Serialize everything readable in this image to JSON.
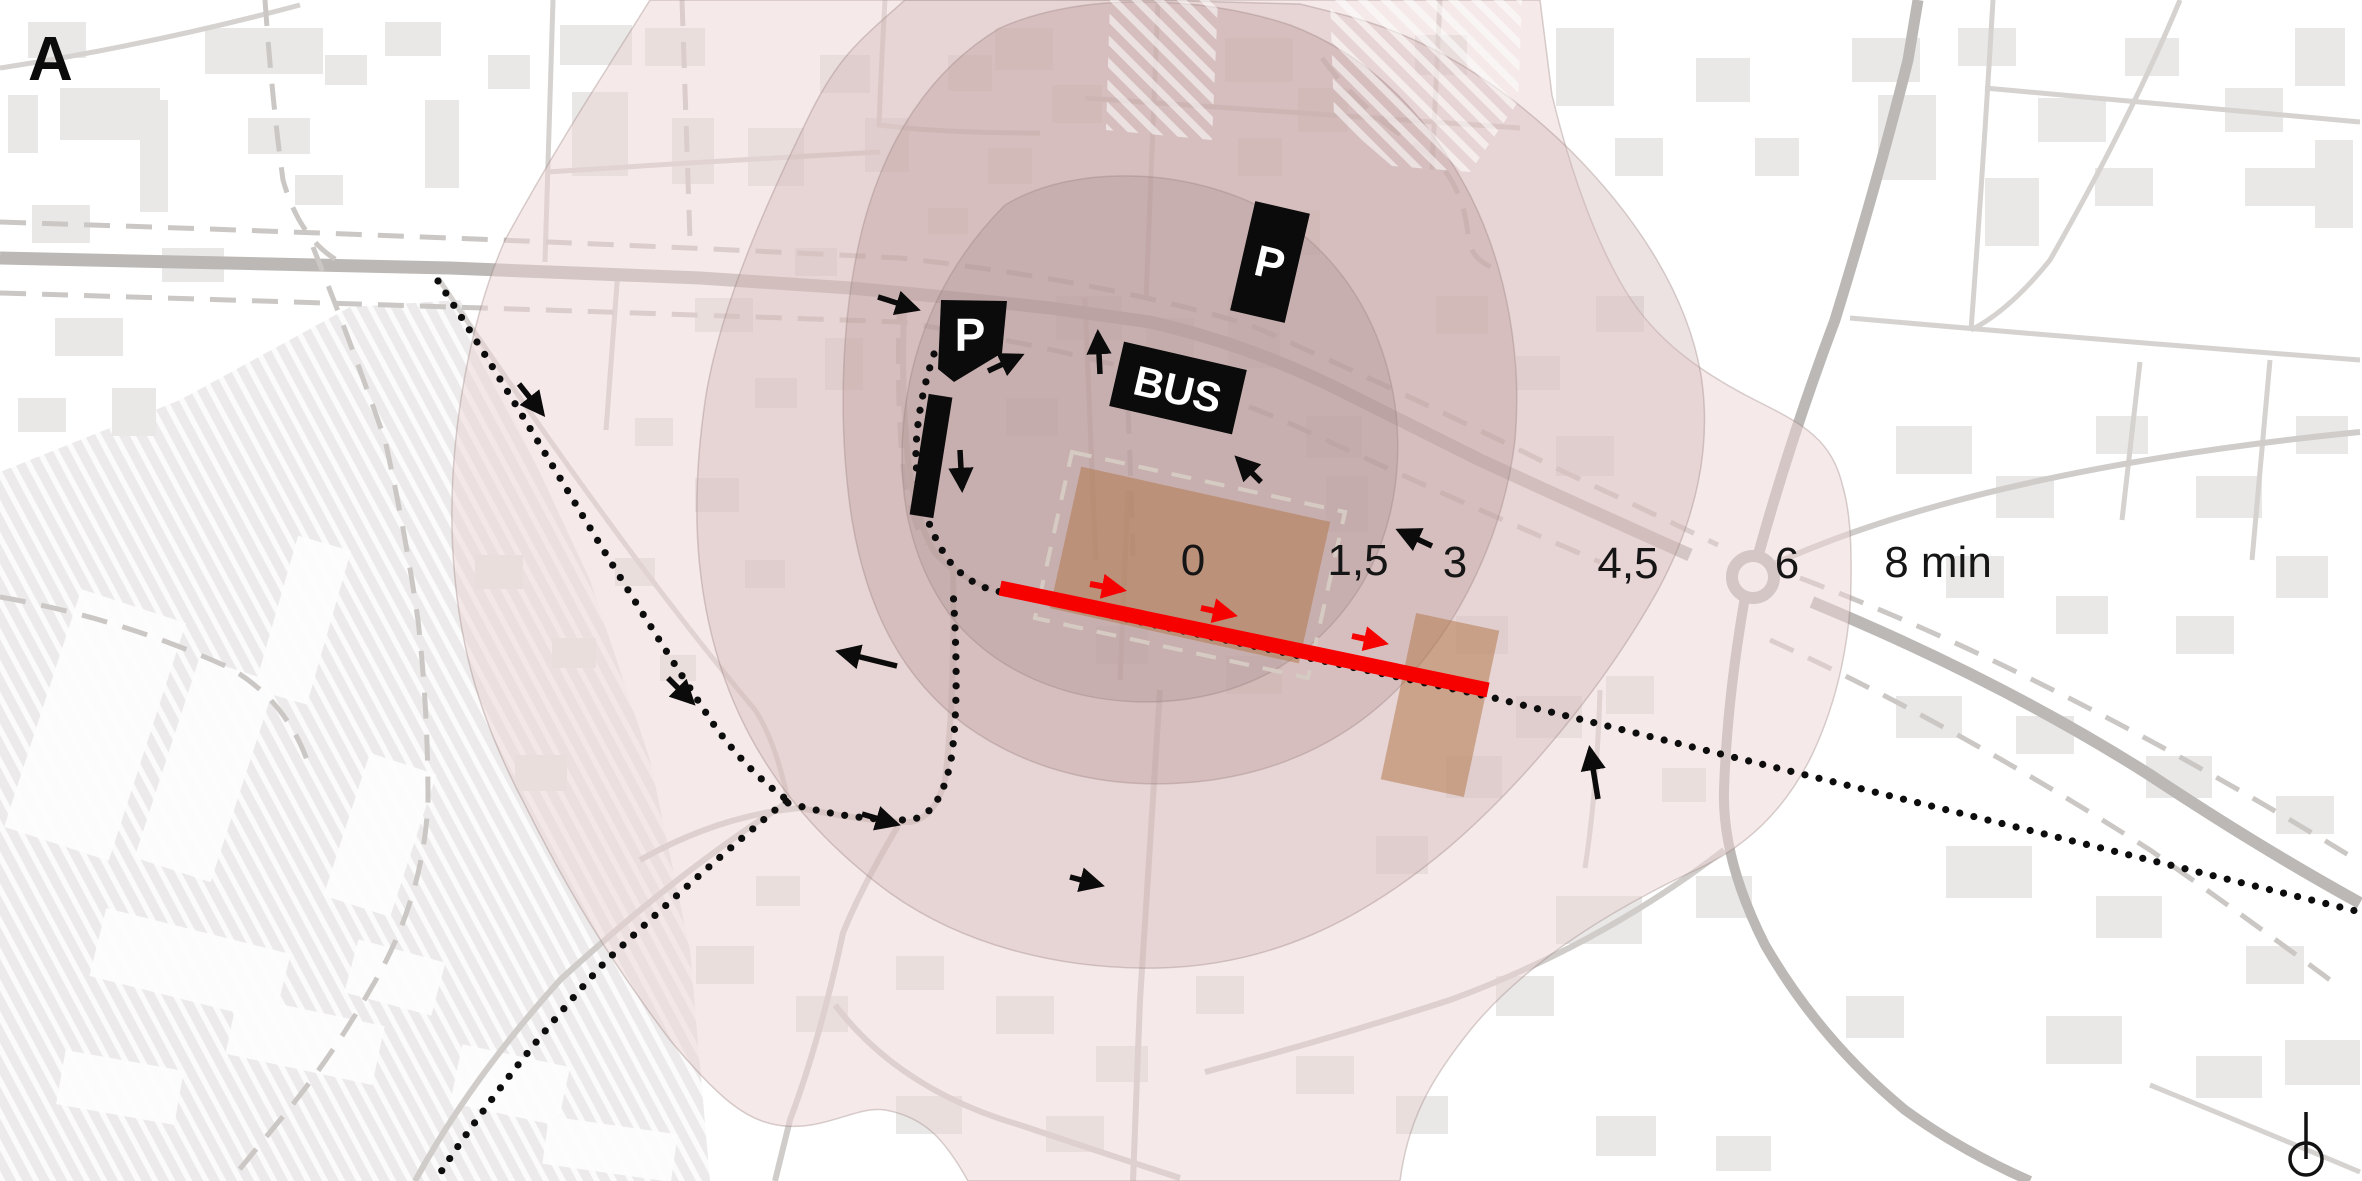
{
  "title_label": "A",
  "walk_time_scale": {
    "unit": "min",
    "labels": [
      "0",
      "1,5",
      "3",
      "4,5",
      "6",
      "8 min"
    ]
  },
  "map_markers": {
    "parking_label": "P",
    "bus_label": "BUS"
  },
  "legend_colors": {
    "isochrone_pink": "#f5e9e9",
    "isochrone_core_mauve": "#c7afae",
    "site_ochre": "#af7344",
    "route_red": "#f70000",
    "infrastructure_black": "#0b0b0b"
  }
}
